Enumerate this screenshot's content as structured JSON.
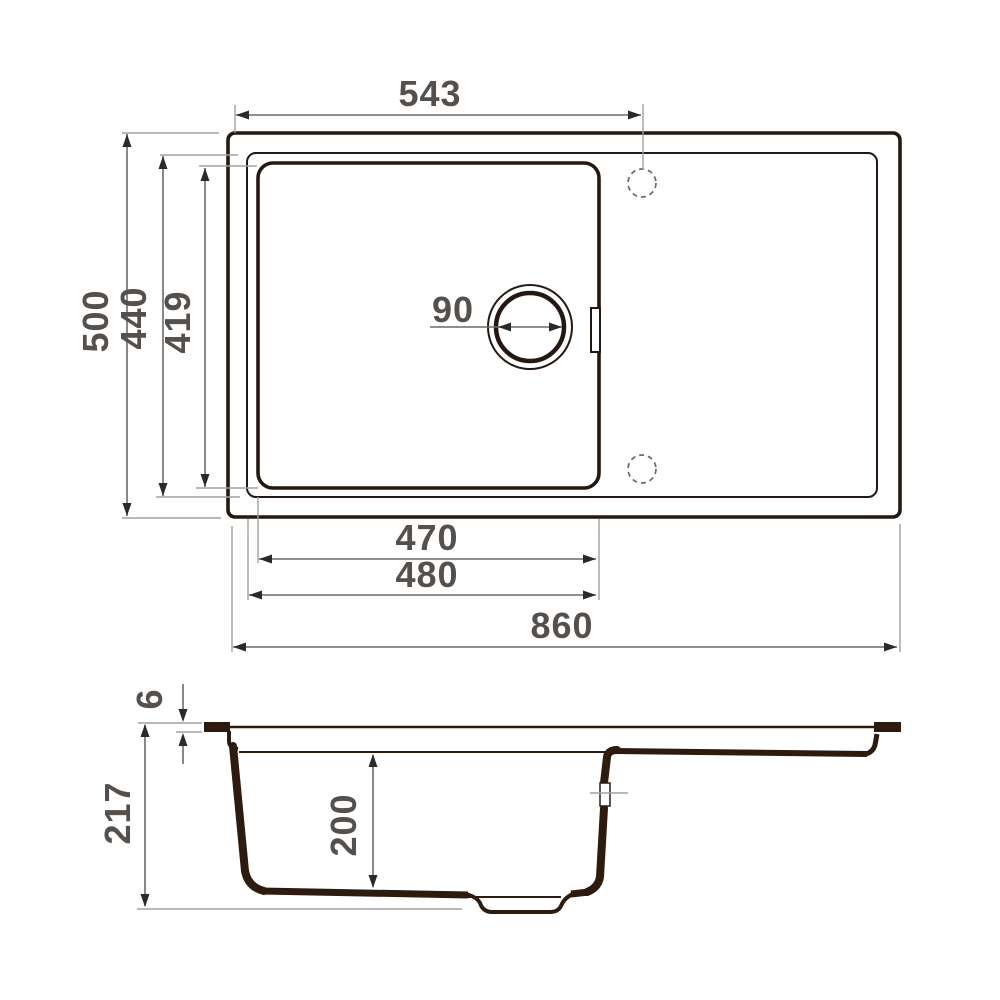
{
  "drawing": {
    "colors": {
      "bg": "#ffffff",
      "line": "#241812",
      "section": "#2d1b10",
      "dim": "#6a6a6a",
      "ext": "#a0a0a0",
      "arrow": "#2a2a2a",
      "text": "#55504c"
    },
    "top_view": {
      "top_width": "543",
      "overall_depth": "500",
      "inner_depth": "440",
      "bowl_length": "419",
      "drain_diameter": "90",
      "bowl_width": "470",
      "bowl_width_outer": "480",
      "overall_width": "860"
    },
    "section_view": {
      "rim_thickness": "6",
      "overall_height": "217",
      "bowl_depth": "200"
    }
  }
}
